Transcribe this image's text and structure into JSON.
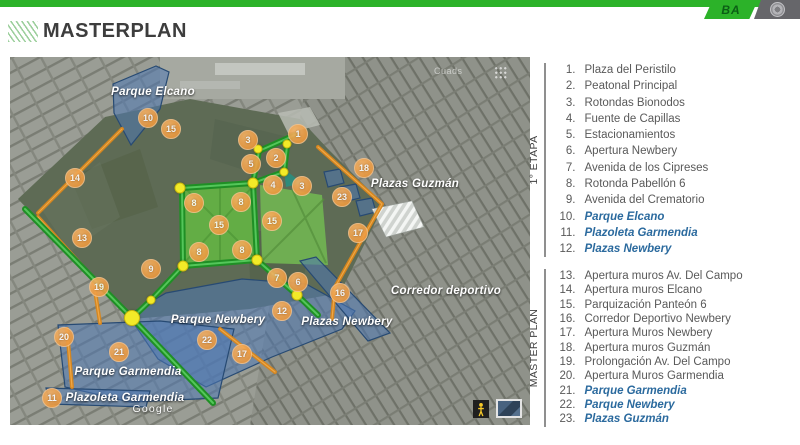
{
  "header": {
    "title": "MASTERPLAN",
    "logo_text": "BA"
  },
  "map": {
    "toolbar_text": "Cuads",
    "attribution": "Google",
    "labels": [
      {
        "text": "Parque Elcano",
        "x": 143,
        "y": 35
      },
      {
        "text": "Plazas Guzmán",
        "x": 405,
        "y": 127
      },
      {
        "text": "Corredor deportivo",
        "x": 436,
        "y": 234
      },
      {
        "text": "Parque Newbery",
        "x": 208,
        "y": 263
      },
      {
        "text": "Plazas Newbery",
        "x": 337,
        "y": 265
      },
      {
        "text": "Parque Garmendia",
        "x": 118,
        "y": 315
      },
      {
        "text": "Plazoleta Garmendia",
        "x": 115,
        "y": 341
      },
      {
        "text": "Google",
        "x": 143,
        "y": 352,
        "small": true
      }
    ],
    "markers": [
      {
        "n": "1",
        "x": 287,
        "y": 76
      },
      {
        "n": "2",
        "x": 265,
        "y": 100
      },
      {
        "n": "3",
        "x": 237,
        "y": 82
      },
      {
        "n": "5",
        "x": 240,
        "y": 106
      },
      {
        "n": "4",
        "x": 262,
        "y": 127
      },
      {
        "n": "3",
        "x": 291,
        "y": 128
      },
      {
        "n": "15",
        "x": 160,
        "y": 71
      },
      {
        "n": "10",
        "x": 137,
        "y": 60
      },
      {
        "n": "14",
        "x": 64,
        "y": 120
      },
      {
        "n": "13",
        "x": 71,
        "y": 180
      },
      {
        "n": "8",
        "x": 183,
        "y": 145
      },
      {
        "n": "8",
        "x": 230,
        "y": 144
      },
      {
        "n": "15",
        "x": 208,
        "y": 167
      },
      {
        "n": "15",
        "x": 261,
        "y": 163
      },
      {
        "n": "8",
        "x": 188,
        "y": 194
      },
      {
        "n": "8",
        "x": 231,
        "y": 192
      },
      {
        "n": "9",
        "x": 140,
        "y": 211
      },
      {
        "n": "19",
        "x": 88,
        "y": 229
      },
      {
        "n": "18",
        "x": 353,
        "y": 110
      },
      {
        "n": "23",
        "x": 331,
        "y": 139
      },
      {
        "n": "17",
        "x": 347,
        "y": 175
      },
      {
        "n": "7",
        "x": 266,
        "y": 220
      },
      {
        "n": "6",
        "x": 287,
        "y": 224
      },
      {
        "n": "16",
        "x": 329,
        "y": 235
      },
      {
        "n": "12",
        "x": 271,
        "y": 253
      },
      {
        "n": "22",
        "x": 196,
        "y": 282
      },
      {
        "n": "17",
        "x": 231,
        "y": 296
      },
      {
        "n": "20",
        "x": 53,
        "y": 279
      },
      {
        "n": "21",
        "x": 108,
        "y": 294
      },
      {
        "n": "11",
        "x": 41,
        "y": 340
      }
    ],
    "nodes": [
      {
        "x": 248,
        "y": 92,
        "r": 3.5
      },
      {
        "x": 277,
        "y": 87,
        "r": 3.5
      },
      {
        "x": 274,
        "y": 115,
        "r": 3.5
      },
      {
        "x": 243,
        "y": 126,
        "r": 4.5
      },
      {
        "x": 170,
        "y": 131,
        "r": 4.5
      },
      {
        "x": 173,
        "y": 209,
        "r": 4.5
      },
      {
        "x": 247,
        "y": 203,
        "r": 4.5
      },
      {
        "x": 287,
        "y": 238,
        "r": 4.5
      },
      {
        "x": 141,
        "y": 243,
        "r": 3.5
      },
      {
        "x": 122,
        "y": 261,
        "r": 7
      }
    ]
  },
  "legend": {
    "sections": [
      {
        "label": "1° ETAPA",
        "items": [
          {
            "no": "1.",
            "text": "Plaza del Peristilo",
            "highlight": false
          },
          {
            "no": "2.",
            "text": "Peatonal Principal",
            "highlight": false
          },
          {
            "no": "3.",
            "text": "Rotondas Bionodos",
            "highlight": false
          },
          {
            "no": "4.",
            "text": "Fuente de Capillas",
            "highlight": false
          },
          {
            "no": "5.",
            "text": "Estacionamientos",
            "highlight": false
          },
          {
            "no": "6.",
            "text": "Apertura Newbery",
            "highlight": false
          },
          {
            "no": "7.",
            "text": "Avenida de los Cipreses",
            "highlight": false
          },
          {
            "no": "8.",
            "text": "Rotonda Pabellón 6",
            "highlight": false
          },
          {
            "no": "9.",
            "text": "Avenida del Crematorio",
            "highlight": false
          },
          {
            "no": "10.",
            "text": "Parque Elcano",
            "highlight": true
          },
          {
            "no": "11.",
            "text": "Plazoleta Garmendia",
            "highlight": true
          },
          {
            "no": "12.",
            "text": "Plazas Newbery",
            "highlight": true
          }
        ]
      },
      {
        "label": "MASTER PLAN",
        "items": [
          {
            "no": "13.",
            "text": "Apertura muros Av. Del Campo",
            "highlight": false
          },
          {
            "no": "14.",
            "text": "Apertura muros Elcano",
            "highlight": false
          },
          {
            "no": "15.",
            "text": "Parquización Panteón 6",
            "highlight": false
          },
          {
            "no": "16.",
            "text": "Corredor Deportivo Newbery",
            "highlight": false
          },
          {
            "no": "17.",
            "text": "Apertura Muros Newbery",
            "highlight": false
          },
          {
            "no": "18.",
            "text": "Apertura muros Guzmán",
            "highlight": false
          },
          {
            "no": "19.",
            "text": "Prolongación Av. Del Campo",
            "highlight": false
          },
          {
            "no": "20.",
            "text": "Apertura Muros Garmendia",
            "highlight": false
          },
          {
            "no": "21.",
            "text": "Parque Garmendia",
            "highlight": true
          },
          {
            "no": "22.",
            "text": "Parque Newbery",
            "highlight": true
          },
          {
            "no": "23.",
            "text": "Plazas Guzmán",
            "highlight": true
          }
        ]
      }
    ]
  },
  "colors": {
    "accent_green": "#2cb229",
    "marker_orange": "#ea8f2e",
    "highlight_blue": "#2b6a9e",
    "overlay_blue": "#4f79b5",
    "road_green": "#1f8f25",
    "road_orange": "#d8861c",
    "node_yellow": "#f2ea28",
    "legend_gray": "#595959"
  }
}
